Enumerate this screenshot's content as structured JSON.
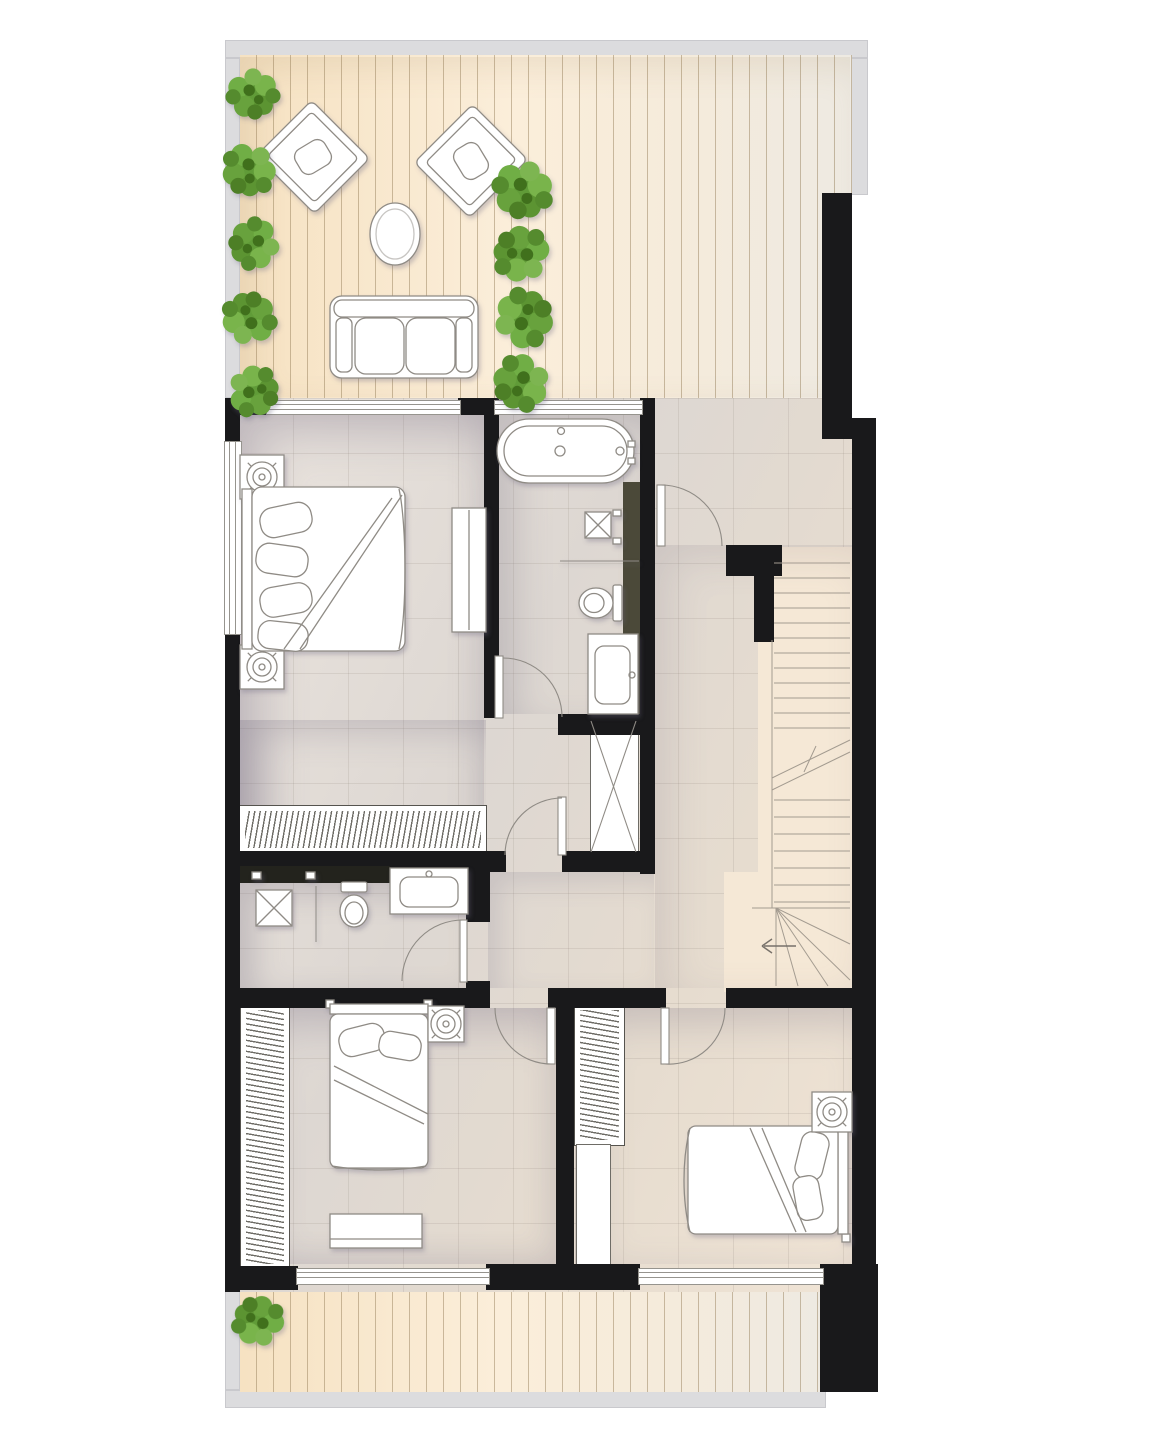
{
  "document": {
    "kind": "architectural floor plan",
    "view": "top-down rendered plan",
    "level": "upper floor with roof terrace and balcony"
  },
  "palette": {
    "wall": "#19191b",
    "exterior_border": "#dcdcde",
    "deck_wood_light": "#fbeeda",
    "deck_wood_base": "#f6e2c2",
    "plank_line": "#947d58",
    "tile_floor": "#e5dfd8",
    "warm_floor": "#f5e8d6",
    "shaft_olive": "#4b4939",
    "fixture_stroke": "#8f8b85",
    "plant_green": "#619b38",
    "pot_dark": "#3c3c33"
  },
  "rooms": [
    {
      "id": "terrace",
      "label": "Roof terrace",
      "floor": "wood decking"
    },
    {
      "id": "master-bedroom",
      "label": "Master bedroom",
      "floor": "tile"
    },
    {
      "id": "master-bathroom",
      "label": "Master bathroom",
      "floor": "tile"
    },
    {
      "id": "walk-in-closet",
      "label": "Walk-in closet",
      "floor": "tile"
    },
    {
      "id": "hallway",
      "label": "Hallway",
      "floor": "tile"
    },
    {
      "id": "staircase",
      "label": "Staircase",
      "floor": "wood"
    },
    {
      "id": "bathroom",
      "label": "Bathroom",
      "floor": "tile"
    },
    {
      "id": "bedroom-left",
      "label": "Bedroom (left)",
      "floor": "tile"
    },
    {
      "id": "bedroom-right",
      "label": "Bedroom (right)",
      "floor": "tile"
    },
    {
      "id": "balcony",
      "label": "Balcony",
      "floor": "wood decking"
    }
  ],
  "furniture": {
    "terrace": [
      "Lounge chair",
      "Lounge chair",
      "Round side table",
      "Two-seat sofa",
      "Planter row (4 shrubs)",
      "Shrub row (5 shrubs)"
    ],
    "master_bedroom": [
      "Double bed",
      "Nightstand",
      "Nightstand",
      "Table lamp",
      "Table lamp",
      "Dresser"
    ],
    "master_bathroom": [
      "Freestanding bathtub",
      "Shower fitting",
      "Toilet",
      "Vanity with sink"
    ],
    "walk_in_closet": [
      "Wardrobe with hangers"
    ],
    "hallway": [
      "Linen cabinet"
    ],
    "bathroom": [
      "Shower",
      "Toilet",
      "Vanity with sink"
    ],
    "bedroom_left": [
      "Wardrobe with hangers",
      "Single bed",
      "Nightstand",
      "Table lamp",
      "Bench"
    ],
    "bedroom_right": [
      "Wardrobe with hangers",
      "Single bed",
      "Nightstand",
      "Table lamp"
    ],
    "balcony": [
      "Shrub"
    ]
  },
  "stairs": {
    "flights": 2,
    "treads_upper": 13,
    "treads_lower": 7,
    "break_symbol": true,
    "direction_arrow": true,
    "winders_at_bottom": true
  },
  "openings": {
    "hinged_doors": 6,
    "sliding_glass_panels": 4,
    "wall_windows": 1
  },
  "plants": {
    "terrace_left": 5,
    "terrace_middle_planter": 4,
    "balcony": 1
  }
}
